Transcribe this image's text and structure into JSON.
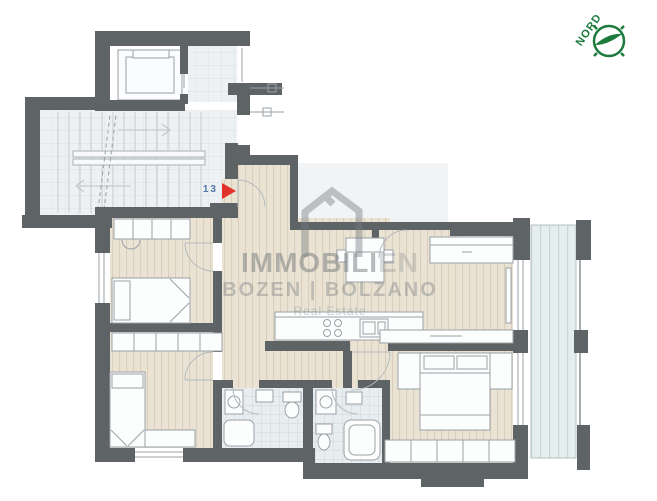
{
  "plan": {
    "unit_number": "13",
    "compass": {
      "label": "NORD",
      "color": "#1c7a3c"
    },
    "watermark": {
      "brand_main": "IMMOBILI",
      "brand_suffix": "EN",
      "subtitle": "BOZEN | BOLZANO",
      "tagline": "Real Estate"
    },
    "legend": {
      "entrance_marker_color": "#e23128",
      "unit_number_color": "#4f74a8",
      "wall_color": "#5e6366",
      "wood_floor_color": "#eae3d4",
      "tile_floor_color": "#e8eef0",
      "balcony_deck_color": "#e4eeed",
      "common_area_floor_color": "#eef1f3",
      "watermark_color": "#74797e"
    }
  }
}
